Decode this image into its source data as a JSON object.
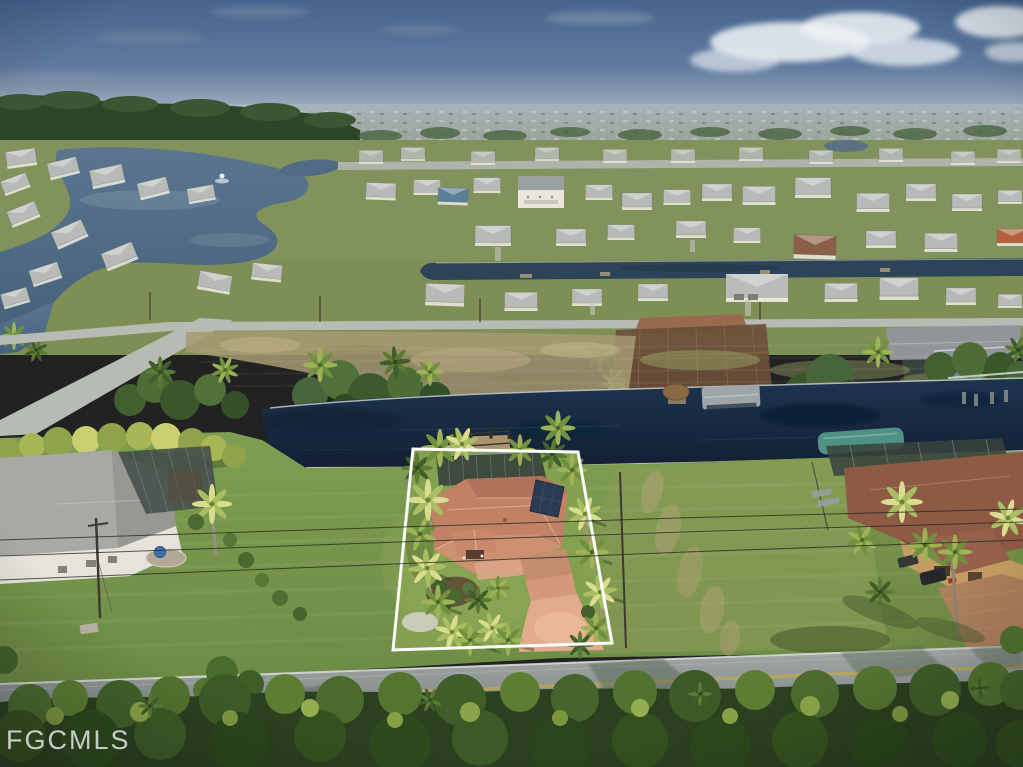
{
  "image": {
    "type": "aerial-drone-photo",
    "subject": "waterfront single-family home highlighted with a white lot-boundary outline",
    "setting": "suburban canal neighborhood with lakes, vacant lots, distant tree line and pine scrub in the foreground"
  },
  "watermark": {
    "text": "FGCMLS",
    "color": "#ebebeb",
    "position": "bottom-left"
  },
  "highlight": {
    "outline_color": "#ffffff",
    "shape": "quadrilateral lot boundary around featured home"
  },
  "features": [
    "blue sky with clouds upper right",
    "distant city horizon",
    "lake with fountain upper left",
    "two canals with boat docks",
    "teal boat-lift canopy",
    "featured house with terracotta tile roof",
    "rooftop solar panels",
    "salmon paver driveway",
    "palm trees",
    "vacant dirt field",
    "asphalt road with yellow centerline",
    "dense pine trees foreground"
  ],
  "palette": {
    "sky_top": "#46648e",
    "sky_horizon": "#b0bbc6",
    "cloud": "#e9edf1",
    "distant_band": "#8f987f",
    "forest": "#2f4629",
    "mid_grass": "#7d8f55",
    "dirt_patch": "#a69a73",
    "lake_water": "#4f6b85",
    "canal_water": "#16263c",
    "seawall": "#ccd0ca",
    "mid_road": "#b5bab3",
    "road_asphalt": "#8f9595",
    "road_centerline": "#c2a94e",
    "road_curb": "#d8dcd6",
    "foreground_lawn": "#7e9c50",
    "property_lawn": "#86a152",
    "main_roof_tile": "#c28468",
    "solar_panel": "#2b3c52",
    "driveway": "#e3ab8d",
    "left_house_roof": "#a6a5a1",
    "left_house_wall": "#e6e3dc",
    "right_house_roof": "#8d5a43",
    "right_house_wall": "#c79d62",
    "boat_canopy_teal": "#4f9184",
    "pool_cage": "#3a443e",
    "palm_bright": "#d9dd8e",
    "palm_mid": "#6f903d",
    "palm_dark": "#3f5e2b",
    "foreground_trees": "#2b401f"
  }
}
